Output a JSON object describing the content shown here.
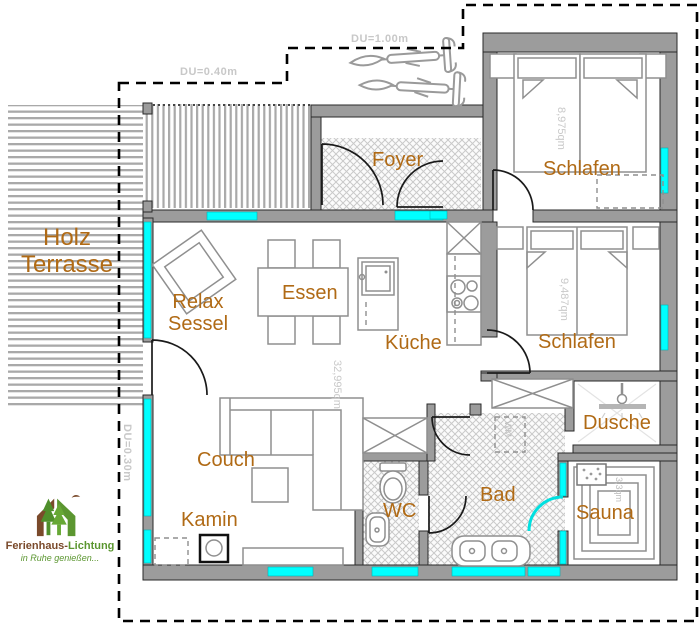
{
  "colors": {
    "window_accent": "#00ffff",
    "wall_gray": "#9c9c9c",
    "room_label": "#b06a15",
    "dim_text": "#c8c8c8",
    "logo_brown": "#7a4a2b",
    "logo_green": "#5b9630"
  },
  "rooms": {
    "terrace_line1": "Holz",
    "terrace_line2": "Terrasse",
    "foyer": "Foyer",
    "bedroom_top": "Schlafen",
    "bedroom_mid": "Schlafen",
    "dining": "Essen",
    "kitchen": "Küche",
    "relax_line1": "Relax",
    "relax_line2": "Sessel",
    "couch": "Couch",
    "fireplace": "Kamin",
    "wc": "WC",
    "bath": "Bad",
    "shower": "Dusche",
    "sauna": "Sauna"
  },
  "dimensions": {
    "roof_overhang_top": "DU=1.00m",
    "roof_overhang_upper_left": "DU=0.40m",
    "roof_overhang_left": "DU=0.30m"
  },
  "areas": {
    "bedroom_top": "8,975qm",
    "bedroom_mid": "9,487qm",
    "living": "32,995qm",
    "sauna": "3,3qm"
  },
  "appliances": {
    "washing_machine": "WM"
  },
  "logo": {
    "name_part1": "Ferienhaus-",
    "name_part2": "Lichtung",
    "tagline": "in Ruhe genießen..."
  }
}
